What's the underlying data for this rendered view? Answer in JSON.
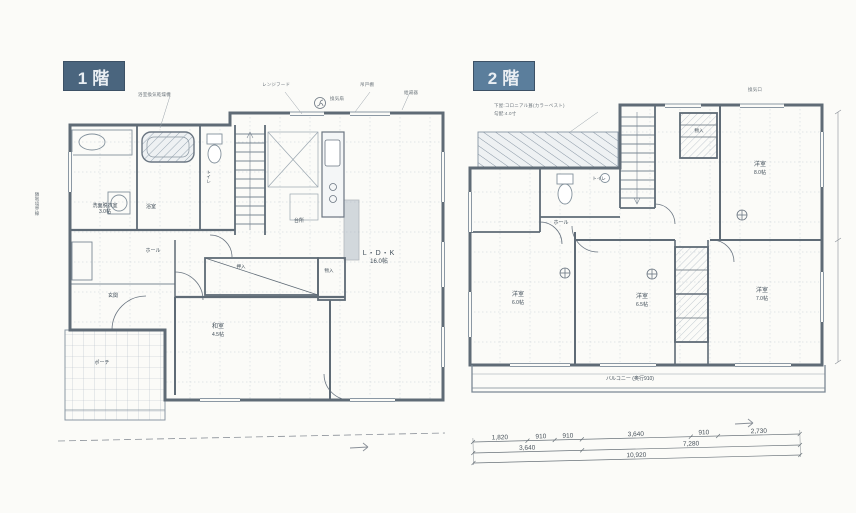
{
  "palette": {
    "tag1_bg": "#4a657e",
    "tag2_bg": "#5b7e9c",
    "wall_line": "#5f6b76",
    "paper": "#fbfbf8"
  },
  "floor1": {
    "tag": "1階",
    "rooms": {
      "washroom": "洗面脱衣室",
      "washroom_size": "3.0帖",
      "bath": "浴室",
      "toilet": "トイレ",
      "kitchen": "台所",
      "ldk": "L・D・K",
      "ldk_size": "16.0帖",
      "washitsu": "和室",
      "washitsu_size": "4.5帖",
      "oshiire": "押入",
      "storage": "物入",
      "hall": "ホール",
      "genkan": "玄関",
      "porch": "ポーチ"
    },
    "notes": {
      "hood": "レンジフード",
      "fan": "換気扇",
      "cupboard": "吊戸棚",
      "heater": "給湯器",
      "bathfan": "浴室換気乾燥機",
      "boundary": "隣地境界線"
    }
  },
  "floor2": {
    "tag": "2階",
    "rooms": {
      "bed1": "洋室",
      "bed1_size": "8.0帖",
      "bed2": "洋室",
      "bed2_size": "6.0帖",
      "bed3": "洋室",
      "bed3_size": "6.5帖",
      "bed4": "洋室",
      "bed4_size": "7.0帖",
      "hall": "ホール",
      "toilet": "トイレ",
      "closet": "物入",
      "balcony": "バルコニー",
      "balcony_size": "(奥行910)"
    },
    "notes": {
      "roof": "下屋:コロニアル葺(カラーベスト)",
      "slope": "勾配:4.0寸",
      "vent": "換気口"
    },
    "dims": {
      "row1": [
        "1,820",
        "910",
        "910",
        "3,640",
        "910",
        "2,730"
      ],
      "row2": [
        "3,640",
        "7,280"
      ],
      "total": "10,920"
    }
  }
}
